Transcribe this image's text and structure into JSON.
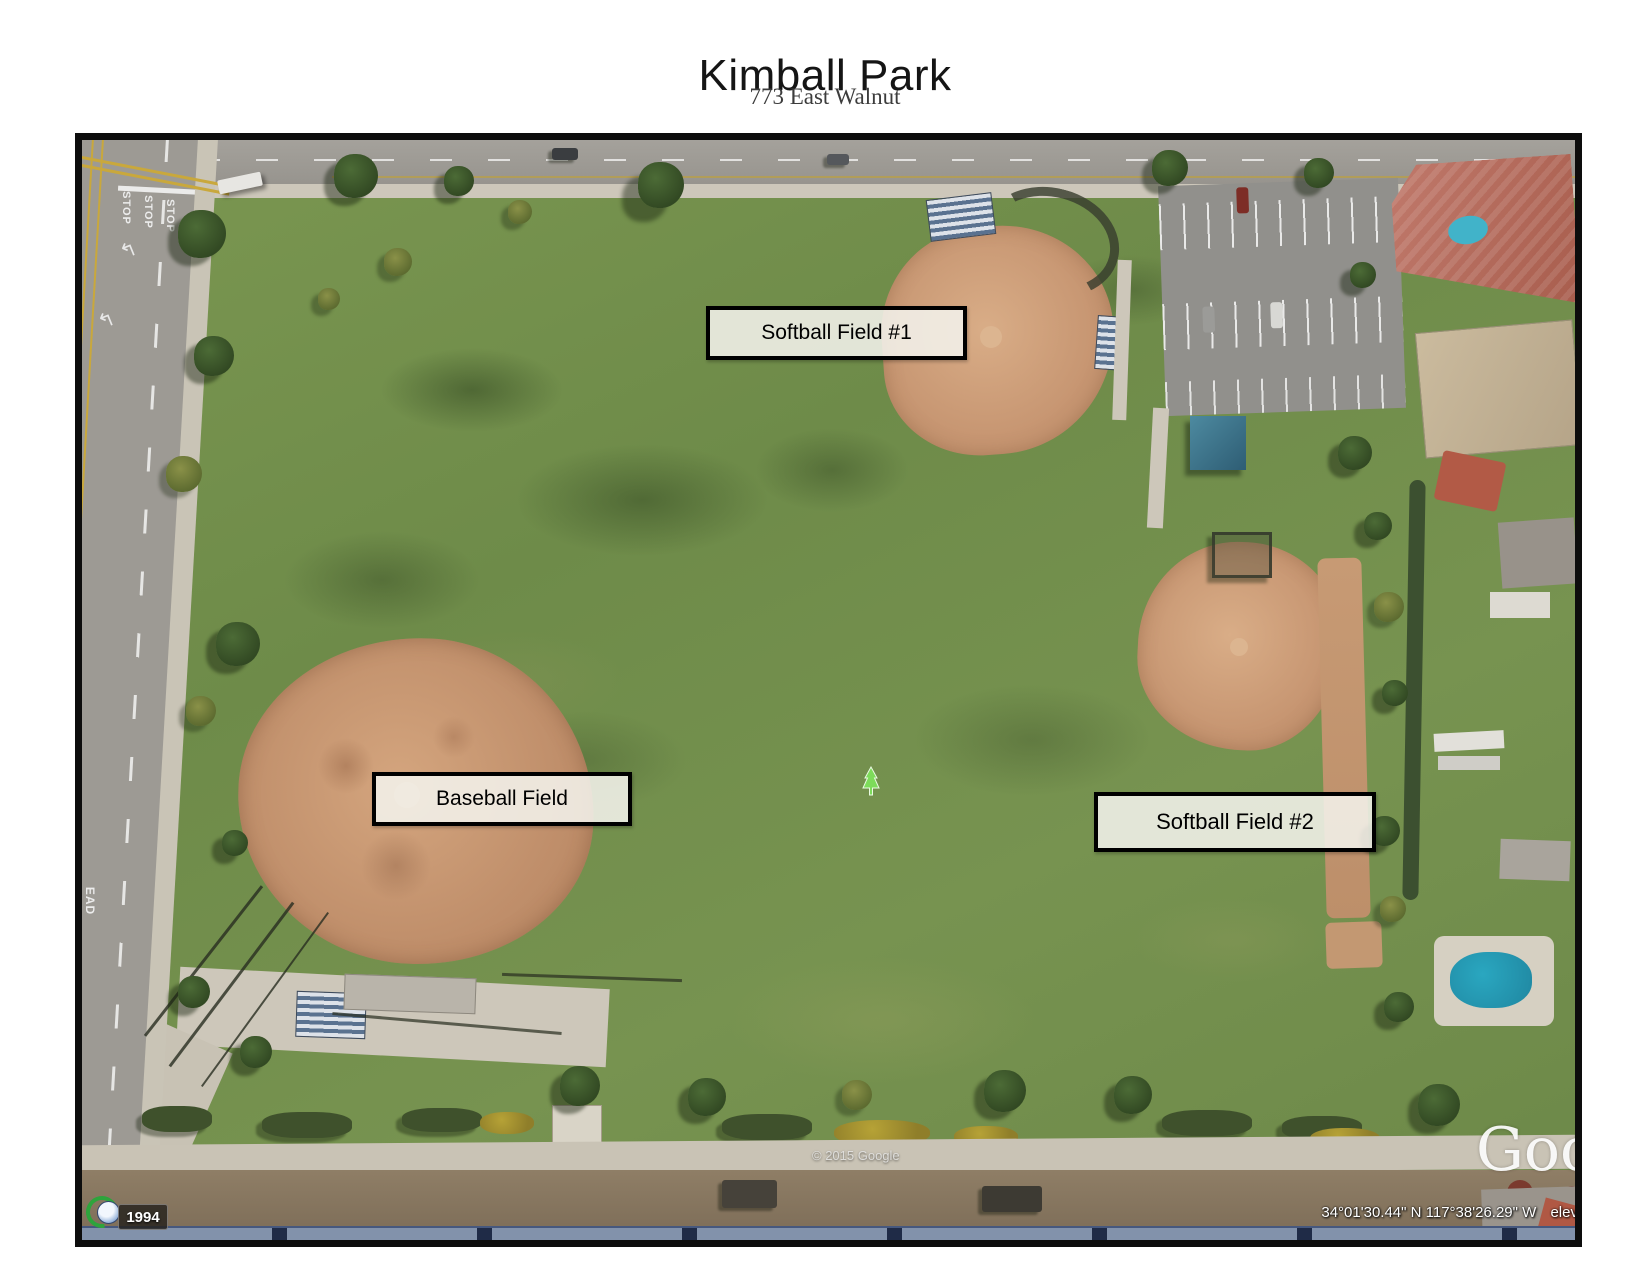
{
  "header": {
    "title": "Kimball Park",
    "subtitle": "773 East Walnut"
  },
  "map": {
    "field_labels": [
      {
        "text": "Softball Field #1"
      },
      {
        "text": "Baseball Field"
      },
      {
        "text": "Softball Field #2"
      }
    ],
    "road_markings": {
      "stop": "STOP",
      "ahead_partial": "EAD",
      "turn_arrow": "↰"
    },
    "watermark": "Goo",
    "copyright": "© 2015 Google",
    "status_bar": {
      "coordinates": "34°01'30.44\" N   117°38'26.29\" W",
      "elevation_prefix": "elev"
    },
    "time_badge": "1994",
    "icons": {
      "historical_imagery": "clock-with-green-arrow",
      "placemark": "green-tree"
    },
    "colors": {
      "grass": "#6f8c4a",
      "infield_dirt": "#c79672",
      "road": "#9d9a94",
      "status_bar_navy": "#1f2b47",
      "label_border": "#000000"
    }
  }
}
